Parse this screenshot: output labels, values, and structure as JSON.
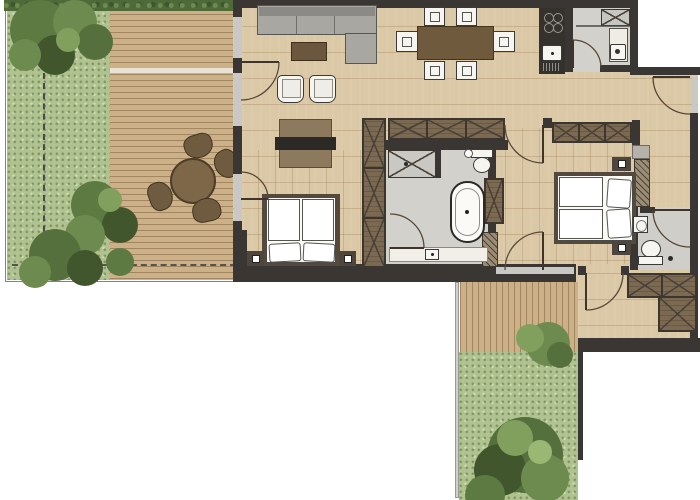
{
  "scene": {
    "kind": "apartment-floor-plan-top-view",
    "background": "#ffffff",
    "width_px": 700,
    "height_px": 500,
    "visible_text": "none"
  },
  "palette": {
    "wall": "#3a3633",
    "wood_floor": "#dbc8a6",
    "deck_planks": "#cbb088",
    "dark_wood_furniture": "#7b6952",
    "tile_floor": "#d2d1cc",
    "grass": "#b0c290",
    "shrub_green": "#5d7a42",
    "white_fixture": "#f7f5f0",
    "sofa_gray": "#a8a7a2",
    "counter_dark": "#35322e"
  },
  "outdoor": {
    "garden_west": {
      "features": [
        "hedge-strip",
        "lawn",
        "shrub-cluster-top",
        "shrub-cluster-mid",
        "shrub-cluster-low",
        "dashed-boundary-line"
      ]
    },
    "terrace_west": {
      "decking": "horizontal-planks",
      "furniture": [
        "round-patio-table",
        "patio-chair",
        "patio-chair",
        "patio-chair",
        "patio-chair"
      ]
    },
    "terrace_south": {
      "decking": "vertical-planks",
      "features": [
        "railing",
        "lawn",
        "large-tree",
        "shrub",
        "garden-wall"
      ]
    }
  },
  "rooms": [
    {
      "name": "living-dining-area",
      "floor": "wood",
      "furniture": [
        "corner-sofa",
        "coffee-table",
        "armchair",
        "armchair",
        "tv-sideboard",
        "dining-table",
        "dining-chair-x6"
      ]
    },
    {
      "name": "kitchen",
      "floor": "wood",
      "fixtures": [
        "counter",
        "cooktop-4-burners",
        "sink-with-drainer"
      ]
    },
    {
      "name": "utility-shower-room",
      "floor": "tile",
      "fixtures": [
        "shower-tray",
        "tall-cabinet",
        "washing-machine"
      ]
    },
    {
      "name": "bedroom-1",
      "floor": "wood",
      "furniture": [
        "double-bed",
        "nightstand",
        "nightstand",
        "built-in-wardrobe"
      ]
    },
    {
      "name": "bathroom",
      "floor": "tile",
      "fixtures": [
        "shower",
        "toilet",
        "freestanding-bathtub",
        "vanity-washbasin",
        "shelf-unit"
      ]
    },
    {
      "name": "bedroom-2",
      "floor": "wood",
      "furniture": [
        "double-bed",
        "nightstand",
        "nightstand",
        "built-in-wardrobe"
      ]
    },
    {
      "name": "wc",
      "floor": "tile",
      "fixtures": [
        "toilet",
        "washbasin"
      ]
    },
    {
      "name": "entrance-hall",
      "floor": "wood",
      "features": [
        "entrance-door",
        "shelf-niche"
      ]
    },
    {
      "name": "vestibule",
      "floor": "wood",
      "furniture": [
        "l-shaped-closet"
      ]
    }
  ],
  "openings": {
    "hinged_doors": 9,
    "glazed_west_wall": true,
    "glazed_south_window": true
  }
}
